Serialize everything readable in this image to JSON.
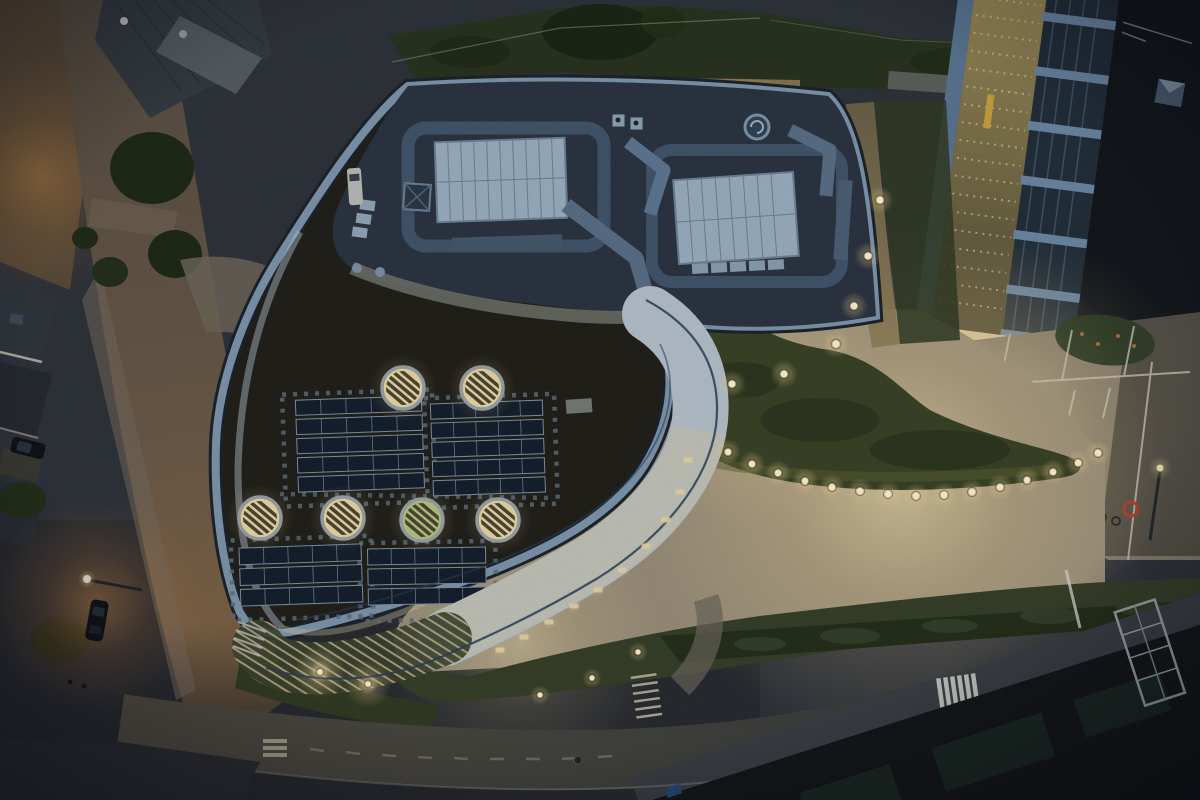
{
  "photo": {
    "kind": "aerial-night-photograph",
    "subject": "curved building with green roof, solar arrays, round skylights, white S-curve canopy, lit plaza and streets at dusk"
  },
  "palette": {
    "base": "#2f333b",
    "base_dark": "#25282e",
    "road_l": "#4f4b43",
    "road_r": "#33373c",
    "lane": "#c9c4b2",
    "road_left_top": "#5a5046",
    "road_left_glow": "#8a6a46",
    "sidewalk": "#756a5c",
    "pale_paving": "#6e665a",
    "grass": "#37402a",
    "grass_dark": "#2a3320",
    "grass_lit": "#4c5430",
    "hedge": "#25301b",
    "tree": "#1f2a18",
    "sedum": "#22211b",
    "slate": "#2c3542",
    "fascia": "#7e96ad",
    "fascia_dark": "#1d242c",
    "fascia_bright": "#bccdd9",
    "duct": "#526881",
    "duct_light": "#7f97ad",
    "panel_pale": "#9cb0c3",
    "panel_grid": "#6e8498",
    "gravel": "#70746a",
    "solar_cell": "#16202d",
    "solar_frame": "#7e93a8",
    "paver": "#5f6d7c",
    "sky_glow": "#ead9a0",
    "sky_green": "#b6c77c",
    "sky_ring": "#9aa3ab",
    "slat": "#4c463a",
    "canopy": "#b6c2cc",
    "canopy_warm": "#d8c7a0",
    "railing": "#2b4156",
    "plaza": "#9a8f7a",
    "mound": "#3a4427",
    "mound_lit": "#565a31",
    "walk_olive": "#97875a",
    "rb_band": "#232f3b",
    "rb_fin": "#6c88a5",
    "rb_roof": "#14181d",
    "rb_edge": "#5a7694",
    "rb_sky": "#4a5d71",
    "parking": "#837b6c",
    "parking_dim": "#56524a",
    "shadow": "#1b1d1c",
    "dark_roof": "#15181b",
    "teal": "#1d2b26",
    "scaffold": "#99a2a7",
    "zebra": "#cbd0ca",
    "glow_orange": "#c98a4a",
    "warm": "#f0dfae",
    "warm_core": "#fff3cf",
    "car": "#101419",
    "van": "#b9bdb9",
    "red": "#b33a2c",
    "soffit": "#e8d5a2",
    "deck": "#8d7a55",
    "wall": "#6e7070",
    "stair": "#c4bcab",
    "white_pad": "#8d948e",
    "curb": "#cdd2cc",
    "steel": "#20262c",
    "dot_row": "#e3d49a",
    "window_blue": "#3d4c5c",
    "ridge": "#8e8e8e",
    "roofA": "#353b42",
    "roofA_light": "#565c62",
    "tarp": "#2a4a72",
    "yellow": "#c9a13c",
    "sign_head": "#d9e6a0"
  },
  "roof": {
    "skylights": [
      {
        "x": 403,
        "y": 388,
        "green": 0
      },
      {
        "x": 482,
        "y": 388,
        "green": 0
      },
      {
        "x": 260,
        "y": 518,
        "green": 0
      },
      {
        "x": 343,
        "y": 518,
        "green": 0
      },
      {
        "x": 422,
        "y": 520,
        "green": 1
      },
      {
        "x": 498,
        "y": 520,
        "green": 0
      }
    ],
    "solar_arrays": [
      {
        "x": 297,
        "y": 398,
        "w": 126,
        "h": 96,
        "rows": 5,
        "cols": 5,
        "rot": -2
      },
      {
        "x": 432,
        "y": 402,
        "w": 112,
        "h": 96,
        "rows": 5,
        "cols": 5,
        "rot": -2
      },
      {
        "x": 240,
        "y": 546,
        "w": 122,
        "h": 62,
        "rows": 3,
        "cols": 5,
        "rot": -2
      },
      {
        "x": 368,
        "y": 548,
        "w": 118,
        "h": 60,
        "rows": 3,
        "cols": 5,
        "rot": -1
      }
    ],
    "paver_grids": [
      {
        "x": 284,
        "y": 392,
        "w": 150,
        "h": 112,
        "rot": -2
      },
      {
        "x": 426,
        "y": 396,
        "w": 130,
        "h": 110,
        "rot": -2
      },
      {
        "x": 232,
        "y": 538,
        "w": 140,
        "h": 80,
        "rot": -2
      },
      {
        "x": 360,
        "y": 542,
        "w": 136,
        "h": 78,
        "rot": -1
      }
    ]
  },
  "lights": {
    "east_path": [
      [
        880,
        200
      ],
      [
        868,
        256
      ],
      [
        854,
        306
      ],
      [
        836,
        344
      ],
      [
        784,
        374
      ],
      [
        732,
        384
      ]
    ],
    "plaza_arc": [
      [
        728,
        452
      ],
      [
        752,
        464
      ],
      [
        778,
        473
      ],
      [
        805,
        481
      ],
      [
        832,
        487
      ],
      [
        860,
        491
      ],
      [
        888,
        494
      ],
      [
        916,
        496
      ],
      [
        944,
        495
      ],
      [
        972,
        492
      ],
      [
        1000,
        487
      ],
      [
        1027,
        480
      ],
      [
        1053,
        472
      ],
      [
        1078,
        463
      ],
      [
        1098,
        453
      ]
    ],
    "canopy_lights": [
      [
        540,
        695
      ],
      [
        592,
        678
      ],
      [
        638,
        652
      ],
      [
        320,
        672
      ],
      [
        368,
        684
      ]
    ],
    "furniture": [
      [
        598,
        590
      ],
      [
        574,
        606
      ],
      [
        549,
        622
      ],
      [
        524,
        637
      ],
      [
        500,
        650
      ],
      [
        622,
        570
      ],
      [
        646,
        546
      ],
      [
        666,
        520
      ],
      [
        680,
        492
      ],
      [
        688,
        460
      ]
    ]
  }
}
